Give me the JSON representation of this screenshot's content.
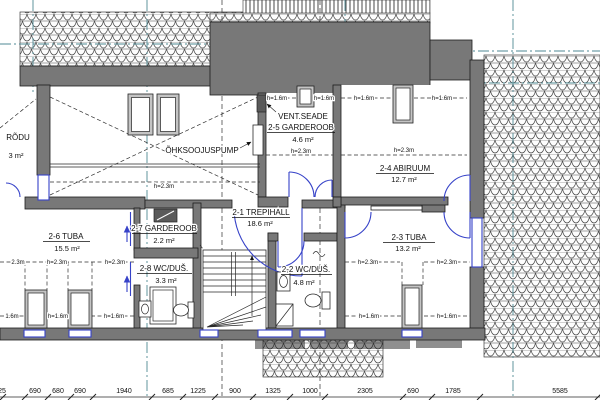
{
  "rooms": {
    "r21": {
      "label": "2-1 TREPIHALL",
      "area": "18.6 m²"
    },
    "r22": {
      "label": "2-2 WC/DUŠ.",
      "area": "4.8 m²"
    },
    "r23": {
      "label": "2-3 TUBA",
      "area": "13.2 m²"
    },
    "r24": {
      "label": "2-4 ABIRUUM",
      "area": "12.7 m²"
    },
    "r25": {
      "label": "2-5 GARDEROOB",
      "area": "4.6 m²"
    },
    "r26": {
      "label": "2-6 TUBA",
      "area": "15.5 m²"
    },
    "r27": {
      "label": "2-7 GARDEROOB",
      "area": "2.2 m²"
    },
    "r28": {
      "label": "2-8 WC/DUŠ.",
      "area": "3.3 m²"
    },
    "balcony": {
      "label": "RÕDU",
      "area": "3 m²"
    }
  },
  "annotations": {
    "vent_unit": "VENT.SEADE",
    "heat_pump": "ÕHKSOOJUSPUMP"
  },
  "heights": {
    "h23": "h=2.3m",
    "h16": "h=1.6m",
    "h23_cut": "2.3m",
    "h16_cut": "1.6m"
  },
  "dimensions": {
    "values": [
      "25",
      "690",
      "680",
      "690",
      "1940",
      "685",
      "1225",
      "900",
      "1325",
      "1000",
      "2305",
      "690",
      "1785",
      "5585"
    ]
  },
  "colors": {
    "wall": "#787878",
    "axis": "#4f8a94",
    "opening": "#3642c8"
  }
}
